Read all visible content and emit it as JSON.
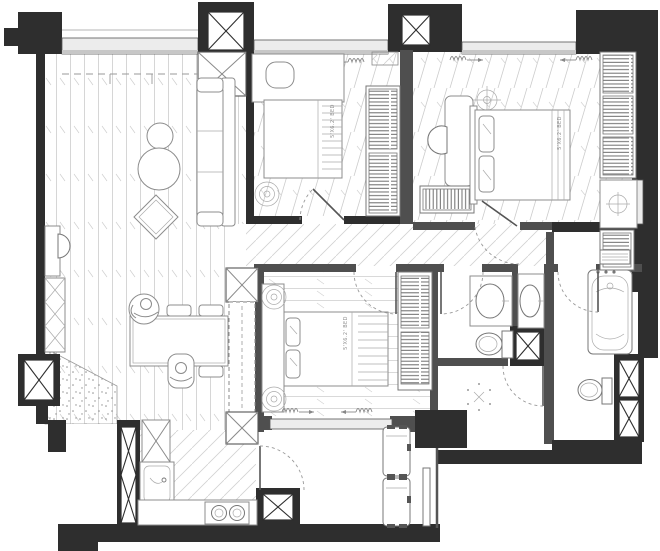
{
  "document": {
    "type": "apartment-floor-plan"
  },
  "labels": {
    "bedroom2_bed": "5'X6.2' BED",
    "master_bed": "5'X6.2' BED",
    "bedroom3_bed": "5'X6.2' BED"
  },
  "colors": {
    "exterior_wall": "#2e2e2e",
    "interior_wall": "#4f4f4f",
    "furniture_line": "#8c8c8c",
    "floor_hatch": "#c9c9c9",
    "window_fill": "#ececec",
    "label_text": "#8f8f8f",
    "background": "#ffffff"
  }
}
